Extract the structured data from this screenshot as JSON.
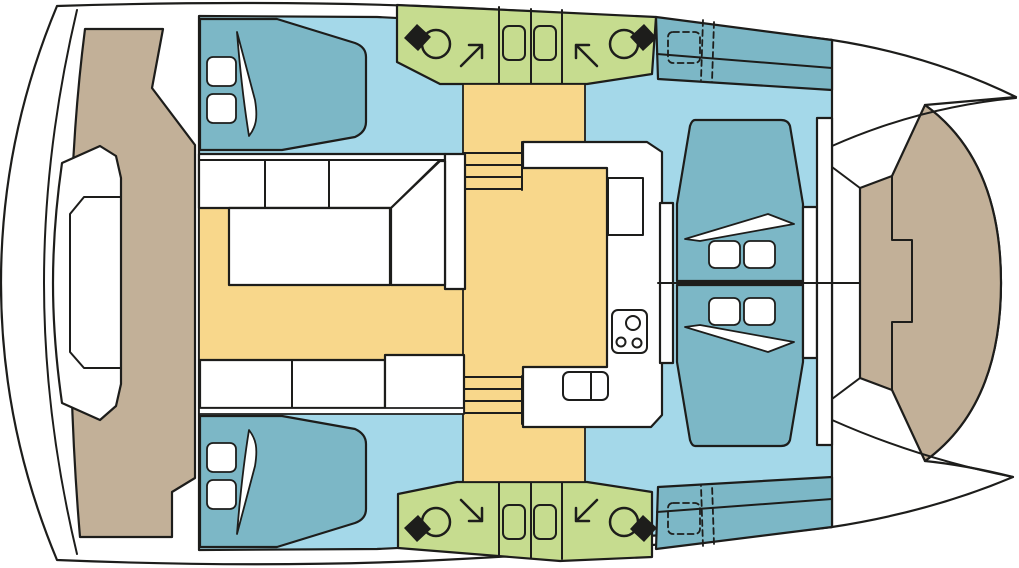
{
  "meta": {
    "view": "catamaran-deck-plan-top-view",
    "orientation": "bow-right-stern-left",
    "has_text": false
  },
  "palette": {
    "outline": "#1d1d1b",
    "hull_white": "#ffffff",
    "cabin_floor_blue": "#a4d8e9",
    "berth_teal": "#7cb7c6",
    "wet_area_green": "#c6dc8f",
    "saloon_floor_yellow": "#f8d78b",
    "deck_tan": "#c2b098",
    "fixture_black": "#1d1d1b"
  },
  "regions": [
    {
      "name": "hull-silhouette",
      "color_key": "hull_white"
    },
    {
      "name": "aft-cockpit-deck",
      "color_key": "deck_tan"
    },
    {
      "name": "cockpit-bench-and-table",
      "color_key": "hull_white"
    },
    {
      "name": "interior-floor",
      "color_key": "cabin_floor_blue"
    },
    {
      "name": "saloon",
      "color_key": "saloon_floor_yellow"
    },
    {
      "name": "galley",
      "color_key": "hull_white"
    },
    {
      "name": "port-head",
      "color_key": "wet_area_green"
    },
    {
      "name": "starboard-head",
      "color_key": "wet_area_green"
    },
    {
      "name": "port-aft-berth",
      "color_key": "berth_teal"
    },
    {
      "name": "starboard-aft-berth",
      "color_key": "berth_teal"
    },
    {
      "name": "port-forepeak-berth",
      "color_key": "berth_teal"
    },
    {
      "name": "starboard-forepeak-berth",
      "color_key": "berth_teal"
    },
    {
      "name": "port-bow-lounger",
      "color_key": "berth_teal"
    },
    {
      "name": "starboard-bow-lounger",
      "color_key": "berth_teal"
    },
    {
      "name": "foredeck",
      "color_key": "deck_tan"
    }
  ],
  "fixtures": {
    "toilets": 4,
    "shower_stalls": 4,
    "double_berths": 2,
    "bow_loungers": 2,
    "forepeak_berths": 2,
    "companionway_stairs": 2,
    "cooktop_burners": 3,
    "sink_basins": 2,
    "saloon_tables": 1,
    "cockpit_tables": 1,
    "door_arrows": 4
  }
}
